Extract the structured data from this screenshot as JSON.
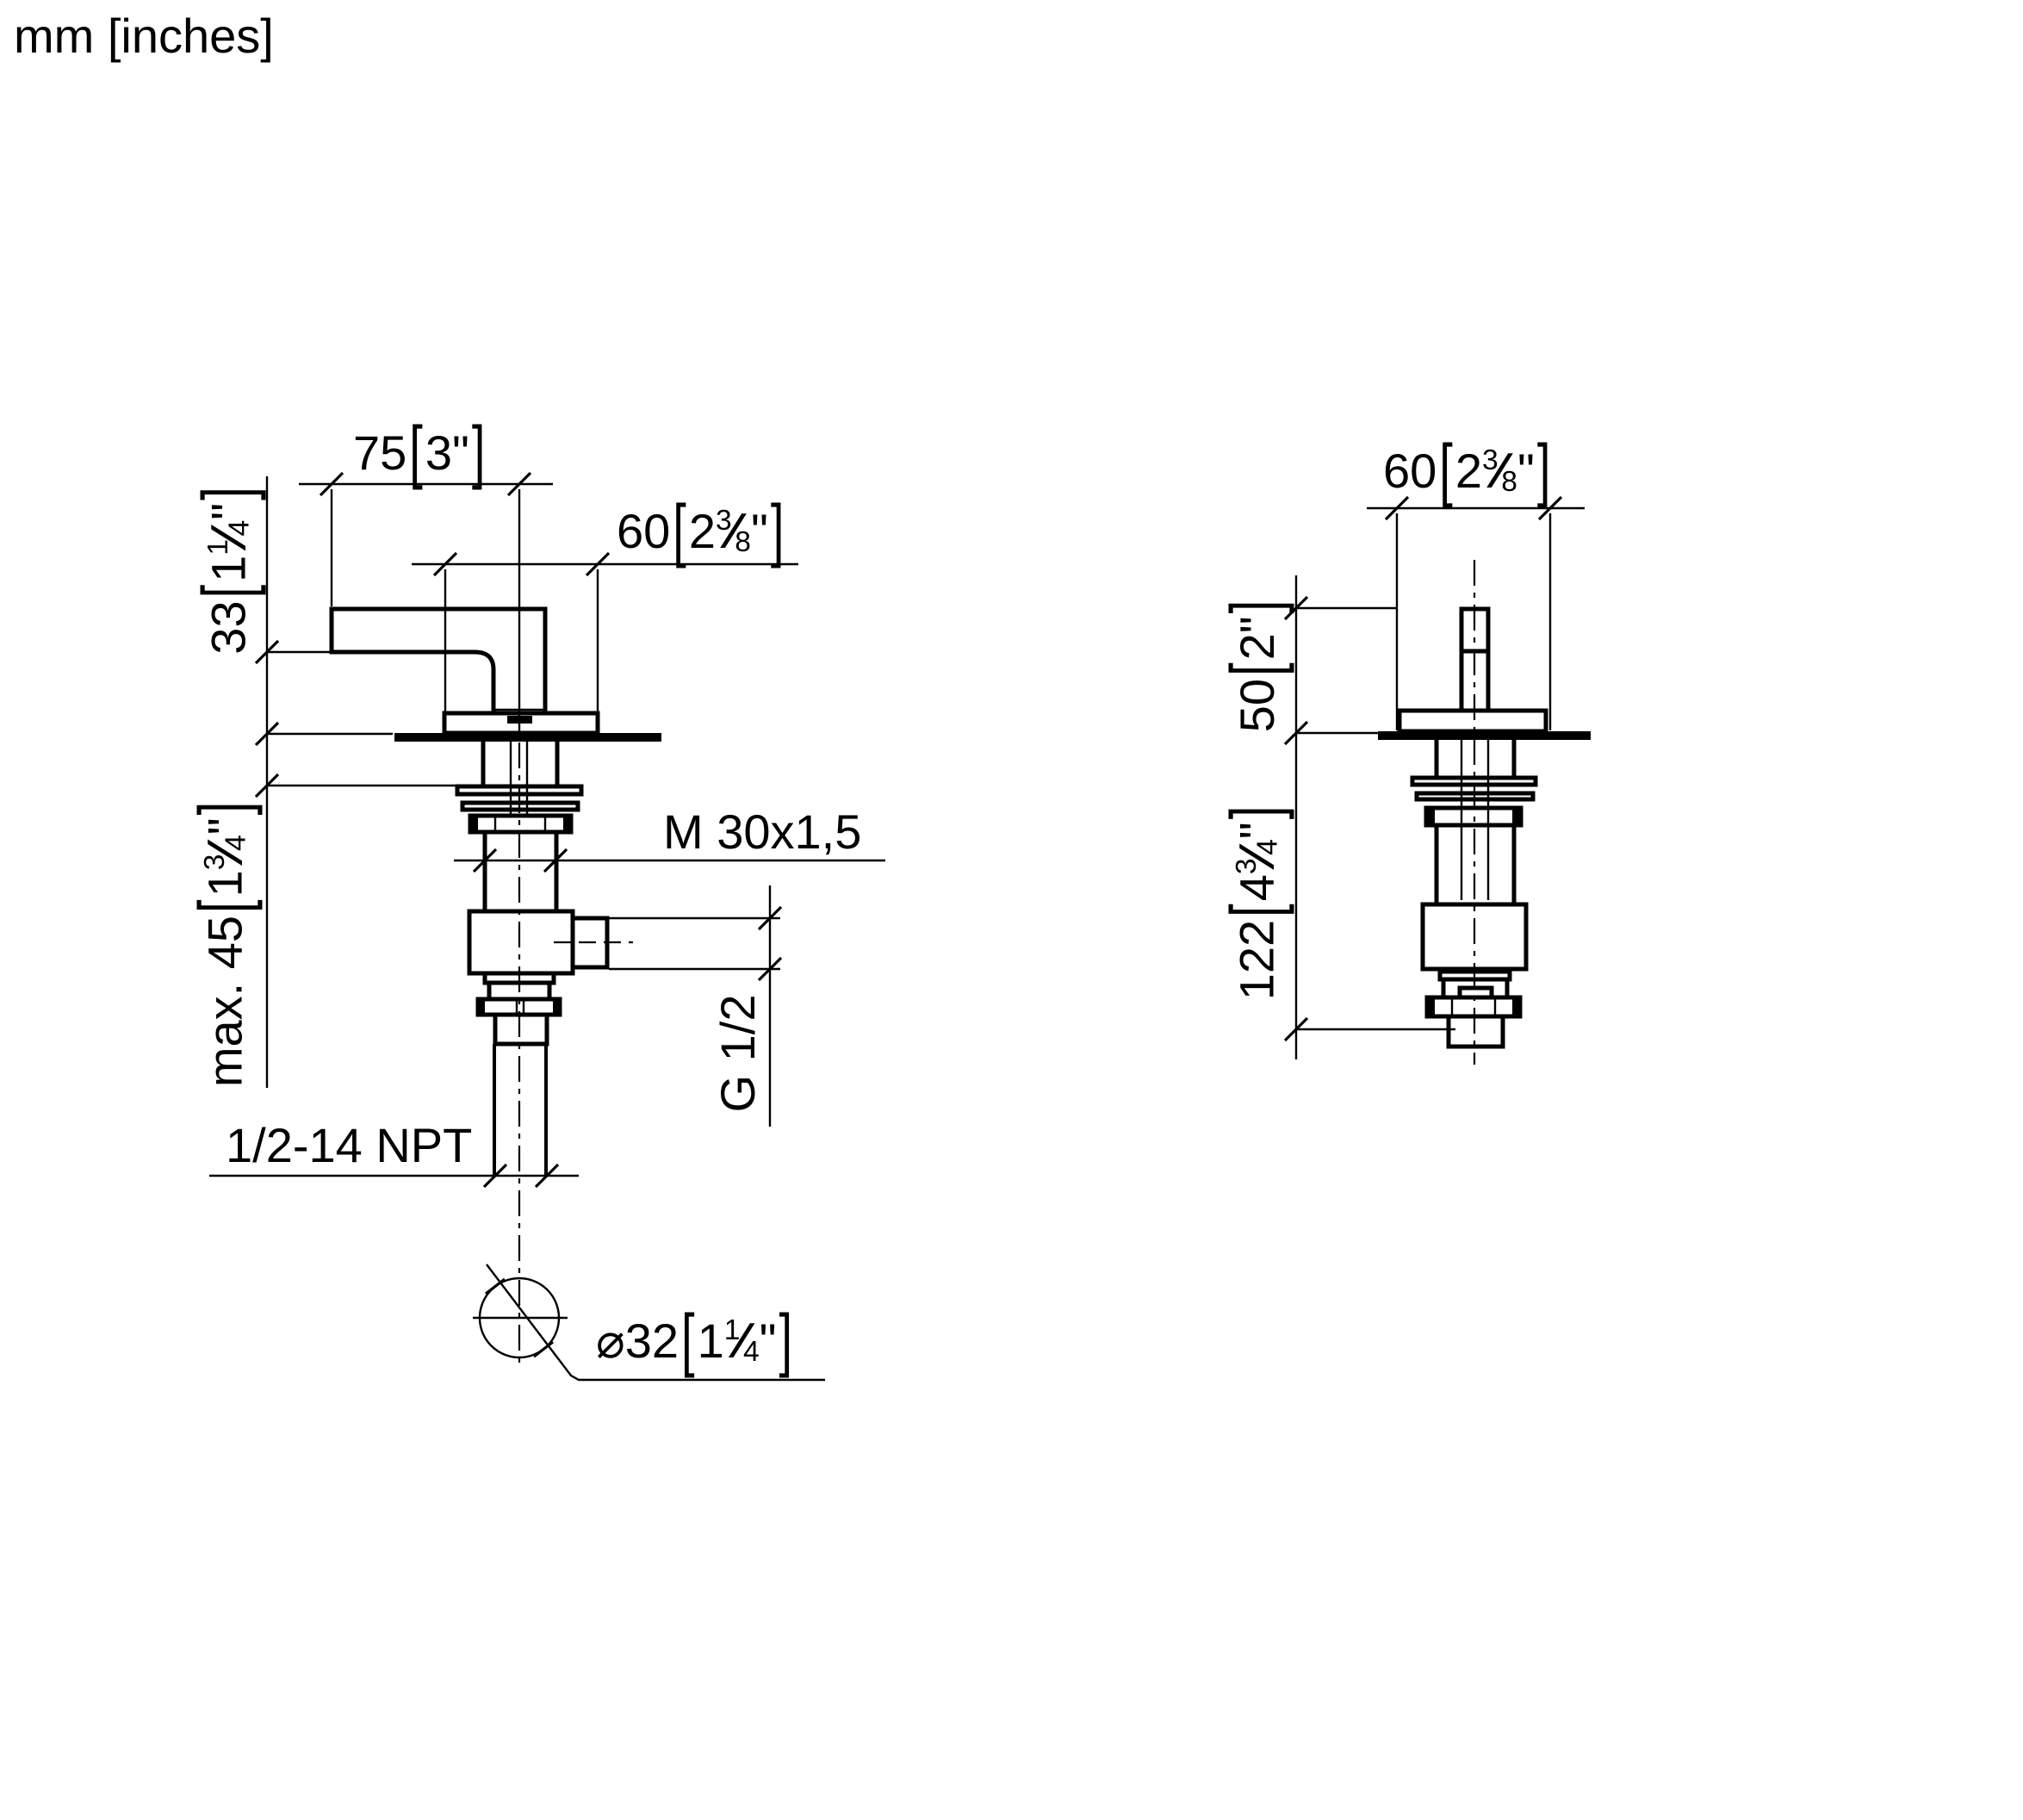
{
  "page": {
    "units_label": "mm [inches]",
    "background_color": "#ffffff",
    "line_color": "#000000"
  },
  "side_view": {
    "title": "side view",
    "labels": {
      "projection": [
        {
          "t": "75"
        },
        {
          "t": "[",
          "s": "br"
        },
        {
          "t": "3\""
        },
        {
          "t": "]",
          "s": "br"
        }
      ],
      "handle_width": [
        {
          "t": "60"
        },
        {
          "t": "[",
          "s": "br"
        },
        {
          "t": "2"
        },
        {
          "t": "3",
          "s": "sup"
        },
        {
          "t": "⁄",
          "s": "sl"
        },
        {
          "t": "8",
          "s": "sub"
        },
        {
          "t": "\""
        },
        {
          "t": "]",
          "s": "br"
        }
      ],
      "height_above_deck": [
        {
          "t": "33"
        },
        {
          "t": "[",
          "s": "br"
        },
        {
          "t": "1"
        },
        {
          "t": "1",
          "s": "sup"
        },
        {
          "t": "⁄",
          "s": "sl"
        },
        {
          "t": "4",
          "s": "sub"
        },
        {
          "t": "\""
        },
        {
          "t": "]",
          "s": "br"
        }
      ],
      "max_deck_thickness": [
        {
          "t": "max. 45"
        },
        {
          "t": "[",
          "s": "br"
        },
        {
          "t": "1"
        },
        {
          "t": "3",
          "s": "sup"
        },
        {
          "t": "⁄",
          "s": "sl"
        },
        {
          "t": "4",
          "s": "sub"
        },
        {
          "t": "\""
        },
        {
          "t": "]",
          "s": "br"
        }
      ],
      "mounting_thread": "M 30x1,5",
      "outlet_thread": "G 1/2",
      "inlet_thread": "1/2-14 NPT",
      "hole_diameter": [
        {
          "t": "⌀"
        },
        {
          "t": "32"
        },
        {
          "t": "[",
          "s": "br"
        },
        {
          "t": "1"
        },
        {
          "t": "1",
          "s": "sup"
        },
        {
          "t": "⁄",
          "s": "sl"
        },
        {
          "t": "4",
          "s": "sub"
        },
        {
          "t": "\""
        },
        {
          "t": "]",
          "s": "br"
        }
      ]
    }
  },
  "front_view": {
    "title": "front view",
    "labels": {
      "width": [
        {
          "t": "60"
        },
        {
          "t": "[",
          "s": "br"
        },
        {
          "t": "2"
        },
        {
          "t": "3",
          "s": "sup"
        },
        {
          "t": "⁄",
          "s": "sl"
        },
        {
          "t": "8",
          "s": "sub"
        },
        {
          "t": "\""
        },
        {
          "t": "]",
          "s": "br"
        }
      ],
      "stem_height": [
        {
          "t": "50"
        },
        {
          "t": "[",
          "s": "br"
        },
        {
          "t": "2\""
        },
        {
          "t": "]",
          "s": "br"
        }
      ],
      "total_depth": [
        {
          "t": "122"
        },
        {
          "t": "[",
          "s": "br"
        },
        {
          "t": "4"
        },
        {
          "t": "3",
          "s": "sup"
        },
        {
          "t": "⁄",
          "s": "sl"
        },
        {
          "t": "4",
          "s": "sub"
        },
        {
          "t": "\""
        },
        {
          "t": "]",
          "s": "br"
        }
      ]
    }
  }
}
